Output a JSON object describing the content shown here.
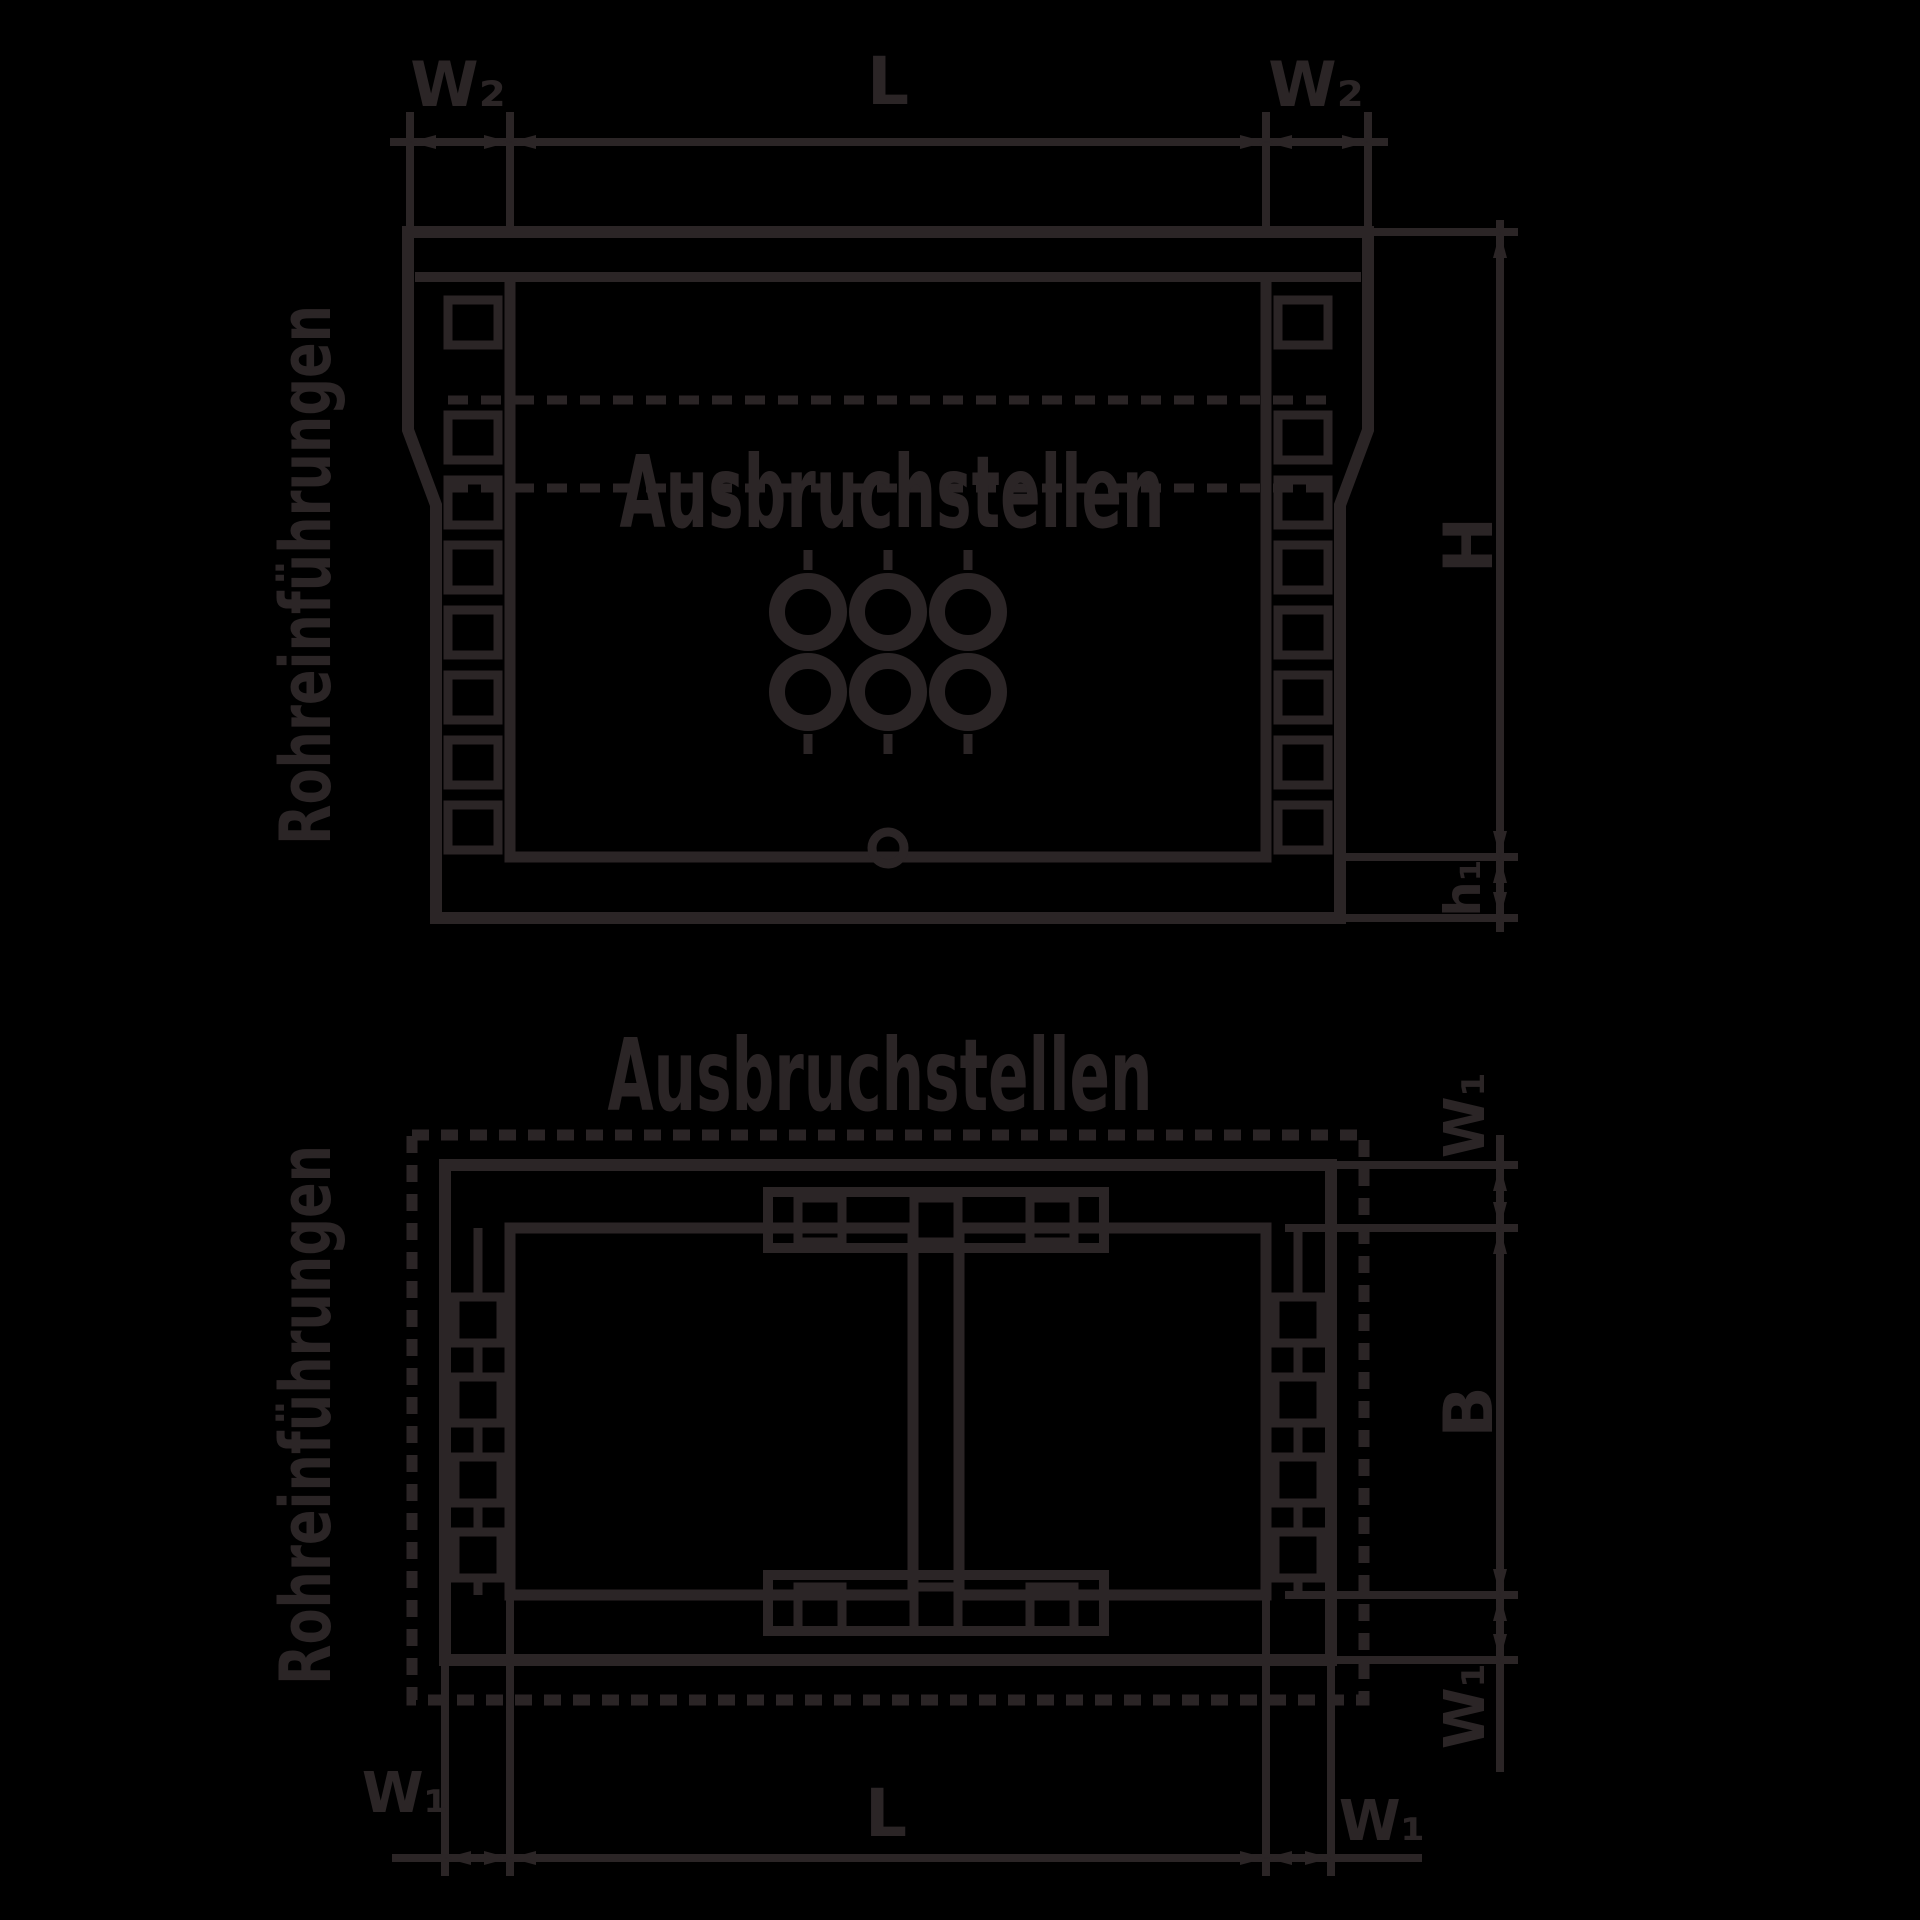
{
  "colors": {
    "background": "#000000",
    "line": "#2b2526"
  },
  "front_view": {
    "title": "Ausbruchstellen",
    "side_label": "Rohreinführungen",
    "dims": {
      "top_left": "W₂",
      "top_center": "L",
      "top_right": "W₂",
      "height": "H",
      "floor": "h₁"
    }
  },
  "plan_view": {
    "title": "Ausbruchstellen",
    "side_label": "Rohreinführungen",
    "dims": {
      "right_top": "W₁",
      "right_center": "B",
      "right_bottom": "W₁",
      "bottom_left": "W₁",
      "bottom_center": "L",
      "bottom_right": "W₁"
    }
  }
}
